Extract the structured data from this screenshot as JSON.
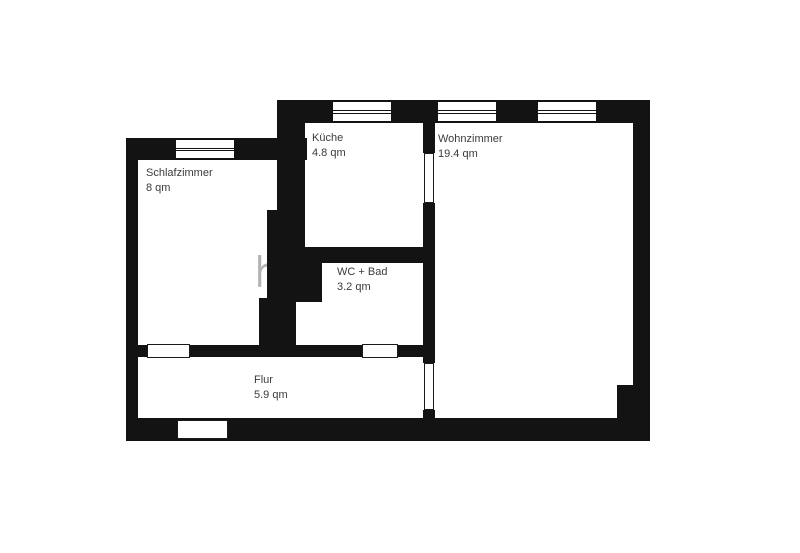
{
  "plan": {
    "title": "Grundriss / floor plan",
    "rooms": [
      {
        "name": "Schlafzimmer",
        "area": "8 qm"
      },
      {
        "name": "Küche",
        "area": "4.8 qm"
      },
      {
        "name": "Wohnzimmer",
        "area": "19.4 qm"
      },
      {
        "name": "WC + Bad",
        "area": "3.2 qm"
      },
      {
        "name": "Flur",
        "area": "5.9 qm"
      }
    ],
    "watermark": {
      "fragment_1": "hnu",
      "fragment_2": "s",
      "color": "#b3b3b3"
    },
    "colors": {
      "wall": "#131313",
      "background": "#ffffff",
      "label_text": "#3b3b3b"
    }
  }
}
